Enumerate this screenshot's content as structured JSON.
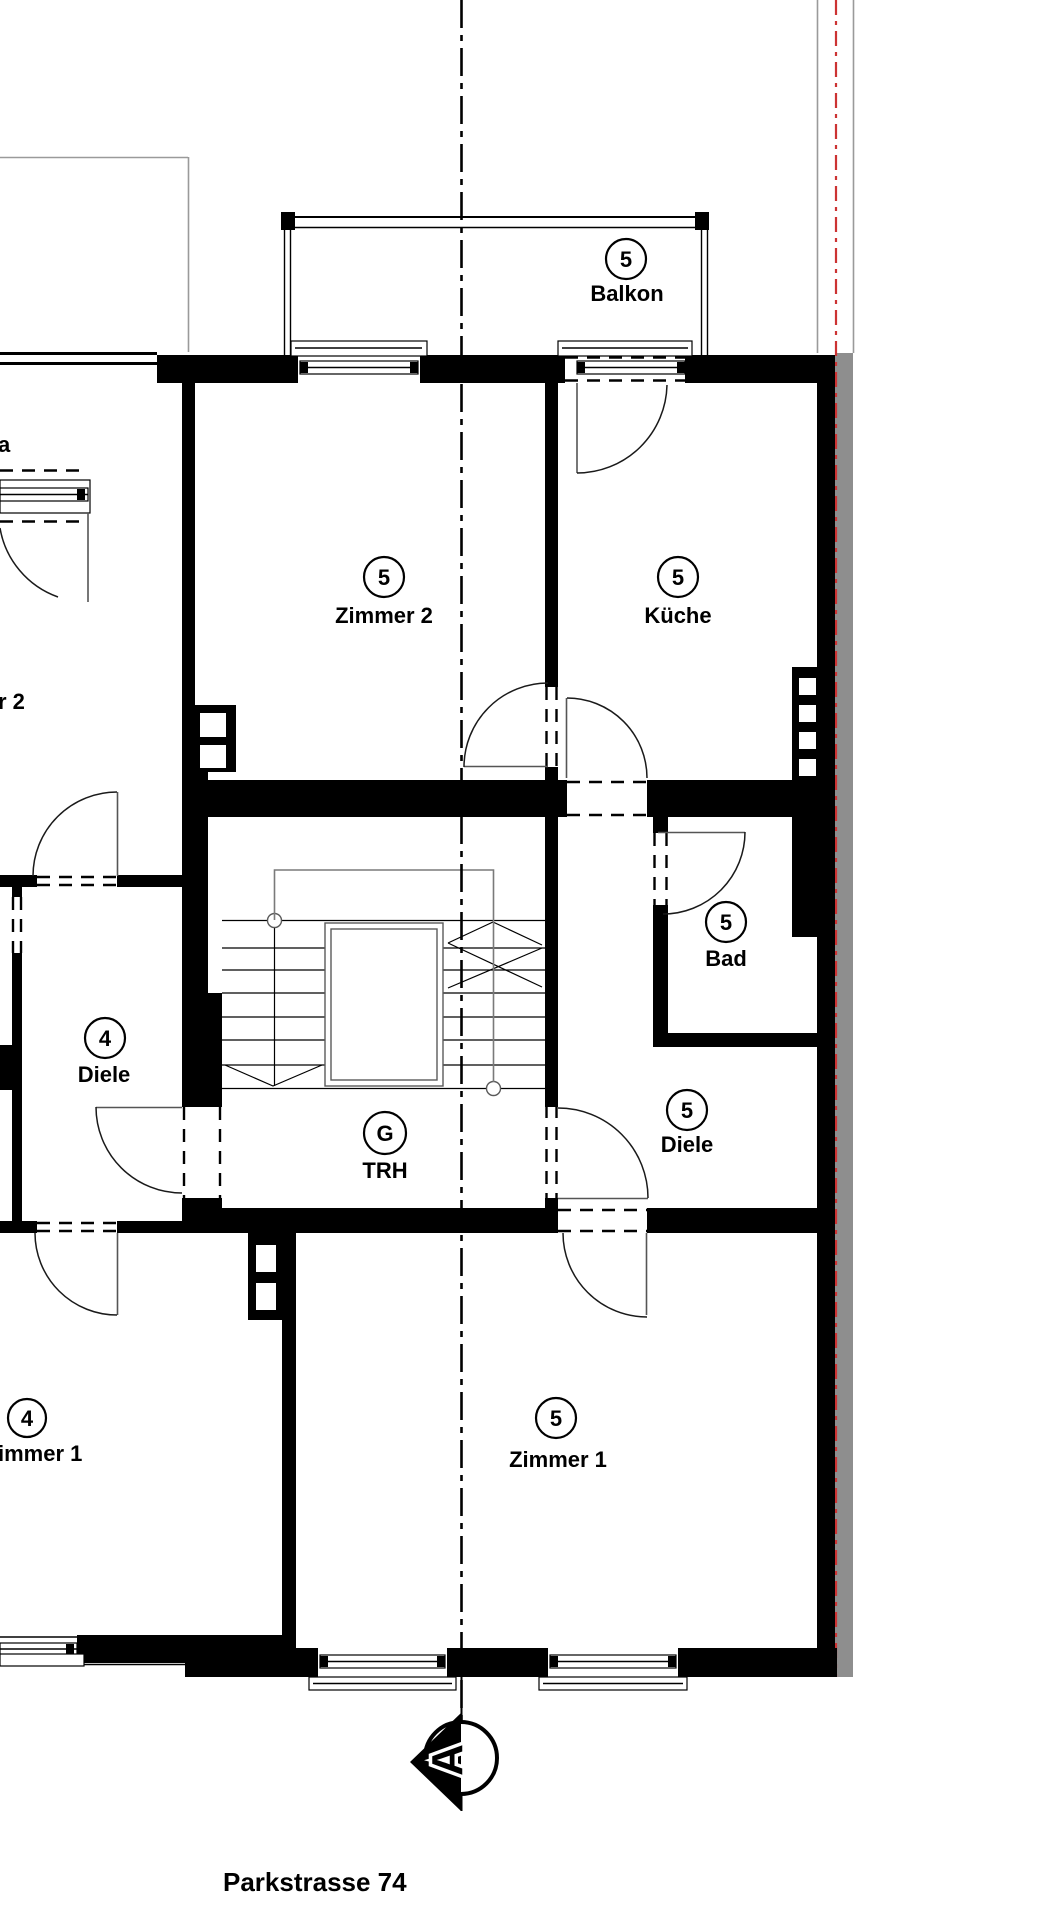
{
  "street_label": "Parkstrasse 74",
  "rooms": {
    "balkon": {
      "number": "5",
      "name": "Balkon"
    },
    "zimmer2": {
      "number": "5",
      "name": "Zimmer 2"
    },
    "kueche": {
      "number": "5",
      "name": "Küche"
    },
    "bad": {
      "number": "5",
      "name": "Bad"
    },
    "diele5": {
      "number": "5",
      "name": "Diele"
    },
    "trh": {
      "number": "G",
      "name": "TRH"
    },
    "diele4": {
      "number": "4",
      "name": "Diele"
    },
    "zimmer1_5": {
      "number": "5",
      "name": "Zimmer 1"
    },
    "zimmer1_4": {
      "number": "4",
      "name": "immer 1"
    }
  },
  "neighbor_fragments": {
    "room_a": "a",
    "room_r2": "r 2"
  },
  "section_marker": {
    "label": "A"
  },
  "colors": {
    "wall": "#000000",
    "party_wall": "#8e8e8e",
    "boundary": "#cc3333",
    "handrail": "#7a7a7a"
  }
}
